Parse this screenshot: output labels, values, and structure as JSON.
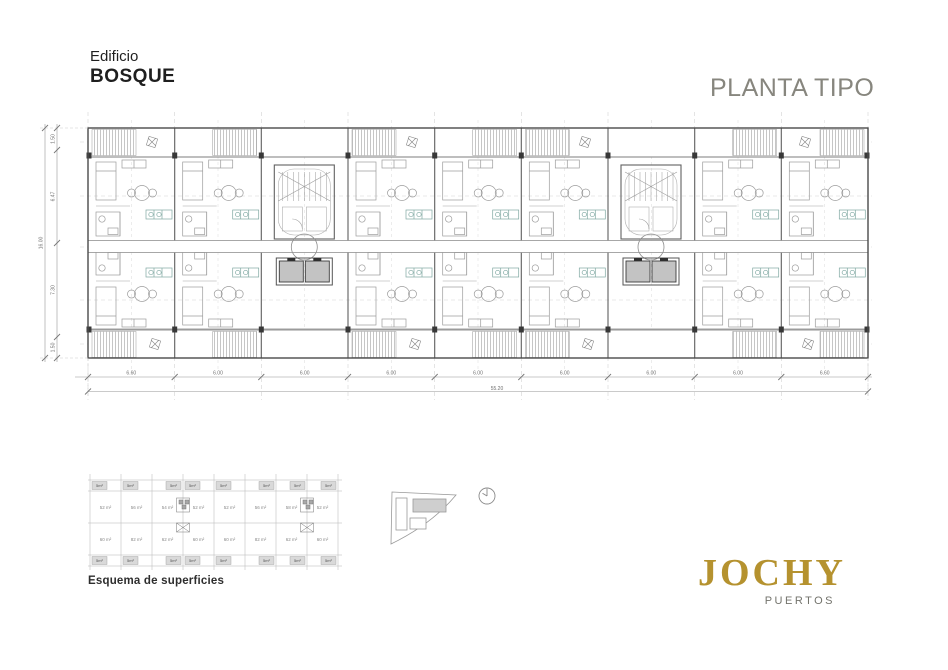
{
  "header": {
    "building_label": "Edificio",
    "building_name": "BOSQUE",
    "plan_title": "PLANTA TIPO"
  },
  "plan": {
    "dims_bottom": [
      "6.60",
      "6.00",
      "6.00",
      "6.00",
      "6.00",
      "6.00",
      "6.00",
      "6.00",
      "6.60"
    ],
    "dims_bottom_total": "55.20",
    "dims_left": [
      "1.50",
      "6.47",
      "7.30",
      "1.50"
    ],
    "dims_left_total": "16.00"
  },
  "schema": {
    "caption": "Esquema de superficies",
    "top_row_areas": [
      "52 m²",
      "56 m²",
      "54 m²",
      "52 m²",
      "52 m²",
      "56 m²",
      "58 m²",
      "52 m²"
    ],
    "bottom_row_areas": [
      "60 m²",
      "82 m²",
      "62 m²",
      "60 m²",
      "60 m²",
      "82 m²",
      "62 m²",
      "60 m²"
    ],
    "balcony_area": "5m²"
  },
  "brand": {
    "name": "JOCHY",
    "subtitle": "PUERTOS",
    "accent_color": "#b5922f"
  },
  "icons": {
    "north_symbol": "north-clock-symbol",
    "site_key": "site-location-key"
  }
}
